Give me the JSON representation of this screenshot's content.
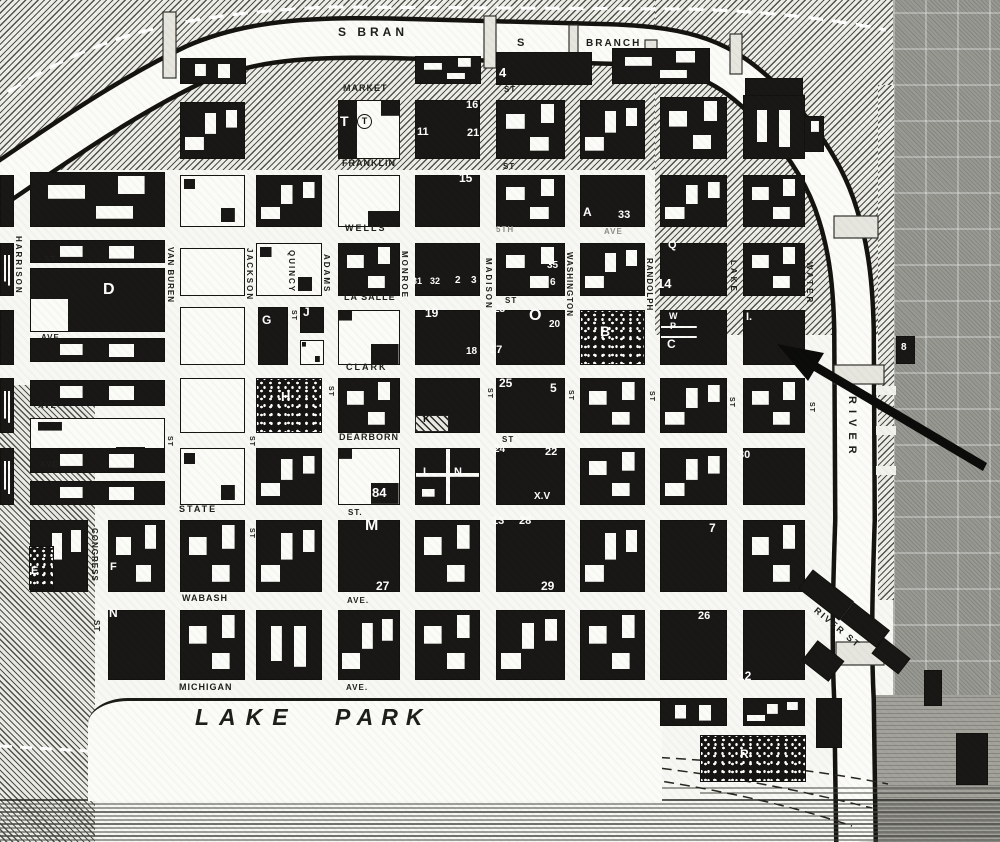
{
  "map": {
    "colors": {
      "paper": "#f7f7f3",
      "ink": "#181715",
      "river_fill": "#fbfbf7",
      "north_side_gray": "#9a9a94",
      "arrow": "#0b0b0a"
    },
    "river_labels_note": "south branch along top, main river on right, lake at bottom",
    "labels": [
      {
        "t": "S BRAN",
        "x": 338,
        "y": 26,
        "s": 12,
        "sp": 4
      },
      {
        "t": "S",
        "x": 517,
        "y": 38,
        "s": 11,
        "sp": 0
      },
      {
        "t": "BRANCH",
        "x": 586,
        "y": 39,
        "s": 10,
        "sp": 2
      },
      {
        "t": "MARKET",
        "x": 343,
        "y": 84,
        "s": 9,
        "sp": 1
      },
      {
        "t": "ST",
        "x": 504,
        "y": 86,
        "s": 8,
        "sp": 1
      },
      {
        "t": "FRANKLIN",
        "x": 342,
        "y": 159,
        "s": 9,
        "sp": 1
      },
      {
        "t": "ST",
        "x": 503,
        "y": 163,
        "s": 8,
        "sp": 1
      },
      {
        "t": "WELLS",
        "x": 345,
        "y": 224,
        "s": 9,
        "sp": 2
      },
      {
        "t": "5TH",
        "x": 496,
        "y": 226,
        "s": 8,
        "sp": 1,
        "c": "#8d8d86"
      },
      {
        "t": "AVE",
        "x": 604,
        "y": 228,
        "s": 8,
        "sp": 1,
        "c": "#8d8d86"
      },
      {
        "t": "LA SALLE",
        "x": 344,
        "y": 293,
        "s": 9,
        "sp": 1
      },
      {
        "t": "ST",
        "x": 505,
        "y": 297,
        "s": 8,
        "sp": 1
      },
      {
        "t": "CLARK",
        "x": 346,
        "y": 363,
        "s": 9,
        "sp": 2
      },
      {
        "t": "DEARBORN",
        "x": 339,
        "y": 433,
        "s": 9,
        "sp": 1
      },
      {
        "t": "ST",
        "x": 502,
        "y": 436,
        "s": 8,
        "sp": 1
      },
      {
        "t": "STATE",
        "x": 179,
        "y": 505,
        "s": 9,
        "sp": 2
      },
      {
        "t": "ST.",
        "x": 348,
        "y": 509,
        "s": 8,
        "sp": 1
      },
      {
        "t": "WABASH",
        "x": 182,
        "y": 594,
        "s": 9,
        "sp": 1
      },
      {
        "t": "AVE.",
        "x": 347,
        "y": 597,
        "s": 8,
        "sp": 1
      },
      {
        "t": "MICHIGAN",
        "x": 179,
        "y": 683,
        "s": 9,
        "sp": 1
      },
      {
        "t": "AVE.",
        "x": 346,
        "y": 684,
        "s": 8,
        "sp": 1
      },
      {
        "t": "ST.",
        "x": 44,
        "y": 256,
        "s": 8,
        "sp": 1
      },
      {
        "t": "AVE.",
        "x": 41,
        "y": 334,
        "s": 8,
        "sp": 1
      },
      {
        "t": "AVE",
        "x": 38,
        "y": 402,
        "s": 8,
        "sp": 1
      },
      {
        "t": "AVE.",
        "x": 40,
        "y": 461,
        "s": 8,
        "sp": 1
      },
      {
        "t": "LAKE",
        "x": 195,
        "y": 706,
        "s": 23,
        "sp": 10,
        "i": 1
      },
      {
        "t": "PARK",
        "x": 335,
        "y": 706,
        "s": 23,
        "sp": 8,
        "i": 1
      },
      {
        "t": "RIVER ST",
        "x": 818,
        "y": 606,
        "s": 9,
        "sp": 2,
        "r": 40
      },
      {
        "t": "HARRISON",
        "x": 14,
        "y": 236,
        "v": 1,
        "s": 8,
        "sp": 2
      },
      {
        "t": "VAN BUREN",
        "x": 166,
        "y": 247,
        "v": 1,
        "s": 8,
        "sp": 1
      },
      {
        "t": "JACKSON",
        "x": 245,
        "y": 248,
        "v": 1,
        "s": 8,
        "sp": 2
      },
      {
        "t": "QUINCY",
        "x": 287,
        "y": 250,
        "v": 1,
        "s": 8,
        "sp": 2
      },
      {
        "t": "ADAMS",
        "x": 322,
        "y": 254,
        "v": 1,
        "s": 8,
        "sp": 2
      },
      {
        "t": "MONROE",
        "x": 400,
        "y": 251,
        "v": 1,
        "s": 8,
        "sp": 2
      },
      {
        "t": "MADISON",
        "x": 484,
        "y": 258,
        "v": 1,
        "s": 8,
        "sp": 2
      },
      {
        "t": "WASHINGTON",
        "x": 565,
        "y": 252,
        "v": 1,
        "s": 8,
        "sp": 1
      },
      {
        "t": "RANDOLPH",
        "x": 645,
        "y": 258,
        "v": 1,
        "s": 8,
        "sp": 1
      },
      {
        "t": "LAKE",
        "x": 729,
        "y": 260,
        "v": 1,
        "s": 8,
        "sp": 3
      },
      {
        "t": "WATER",
        "x": 805,
        "y": 262,
        "v": 1,
        "s": 8,
        "sp": 3
      },
      {
        "t": "CONGRESS",
        "x": 90,
        "y": 528,
        "v": 1,
        "s": 8,
        "sp": 1
      },
      {
        "t": "ST",
        "x": 92,
        "y": 620,
        "v": 1,
        "s": 8,
        "sp": 1
      },
      {
        "t": "RIVER",
        "x": 846,
        "y": 396,
        "v": 1,
        "s": 11,
        "sp": 6
      },
      {
        "t": "ST",
        "x": 290,
        "y": 310,
        "v": 1,
        "s": 7,
        "sp": 1
      },
      {
        "t": "ST",
        "x": 327,
        "y": 386,
        "v": 1,
        "s": 7,
        "sp": 1
      },
      {
        "t": "ST",
        "x": 486,
        "y": 388,
        "v": 1,
        "s": 7,
        "sp": 1
      },
      {
        "t": "ST",
        "x": 567,
        "y": 390,
        "v": 1,
        "s": 7,
        "sp": 1
      },
      {
        "t": "ST",
        "x": 648,
        "y": 391,
        "v": 1,
        "s": 7,
        "sp": 1
      },
      {
        "t": "ST",
        "x": 728,
        "y": 397,
        "v": 1,
        "s": 7,
        "sp": 1
      },
      {
        "t": "ST",
        "x": 808,
        "y": 402,
        "v": 1,
        "s": 7,
        "sp": 1
      },
      {
        "t": "ST",
        "x": 166,
        "y": 436,
        "v": 1,
        "s": 7,
        "sp": 1
      },
      {
        "t": "ST",
        "x": 248,
        "y": 436,
        "v": 1,
        "s": 7,
        "sp": 1
      },
      {
        "t": "ST",
        "x": 248,
        "y": 528,
        "v": 1,
        "s": 7,
        "sp": 1
      }
    ],
    "building_marks": [
      {
        "t": "4",
        "x": 499,
        "y": 66,
        "s": 13
      },
      {
        "t": "T",
        "x": 340,
        "y": 114,
        "s": 14
      },
      {
        "t": "T",
        "x": 357,
        "y": 114,
        "s": 9,
        "c": "b",
        "circ": 1
      },
      {
        "t": "11",
        "x": 417,
        "y": 127,
        "s": 11
      },
      {
        "t": "16",
        "x": 466,
        "y": 100,
        "s": 11
      },
      {
        "t": "21",
        "x": 467,
        "y": 128,
        "s": 11
      },
      {
        "t": "15",
        "x": 459,
        "y": 172,
        "s": 12
      },
      {
        "t": "A",
        "x": 583,
        "y": 206,
        "s": 12
      },
      {
        "t": "33",
        "x": 618,
        "y": 210,
        "s": 11
      },
      {
        "t": "Q",
        "x": 668,
        "y": 240,
        "s": 11
      },
      {
        "t": "14",
        "x": 657,
        "y": 277,
        "s": 13
      },
      {
        "t": "31",
        "x": 412,
        "y": 277,
        "s": 9
      },
      {
        "t": "32",
        "x": 430,
        "y": 277,
        "s": 9
      },
      {
        "t": "2",
        "x": 455,
        "y": 276,
        "s": 10
      },
      {
        "t": "3",
        "x": 471,
        "y": 276,
        "s": 10
      },
      {
        "t": "35",
        "x": 547,
        "y": 261,
        "s": 10
      },
      {
        "t": "6",
        "x": 550,
        "y": 278,
        "s": 10
      },
      {
        "t": "19",
        "x": 425,
        "y": 307,
        "s": 12
      },
      {
        "t": "23",
        "x": 494,
        "y": 305,
        "s": 10
      },
      {
        "t": "O",
        "x": 529,
        "y": 308,
        "s": 16
      },
      {
        "t": "20",
        "x": 549,
        "y": 320,
        "s": 10
      },
      {
        "t": "18",
        "x": 466,
        "y": 347,
        "s": 10
      },
      {
        "t": "17",
        "x": 490,
        "y": 345,
        "s": 11
      },
      {
        "t": "B",
        "x": 600,
        "y": 324,
        "s": 14
      },
      {
        "t": "W",
        "x": 669,
        "y": 312,
        "s": 9
      },
      {
        "t": "P",
        "x": 670,
        "y": 322,
        "s": 9
      },
      {
        "t": "C",
        "x": 667,
        "y": 338,
        "s": 12
      },
      {
        "t": "I.",
        "x": 746,
        "y": 312,
        "s": 11
      },
      {
        "t": "D",
        "x": 103,
        "y": 282,
        "s": 16
      },
      {
        "t": "G",
        "x": 262,
        "y": 314,
        "s": 12
      },
      {
        "t": "J",
        "x": 303,
        "y": 306,
        "s": 12
      },
      {
        "t": "H",
        "x": 281,
        "y": 390,
        "s": 13
      },
      {
        "t": "K",
        "x": 423,
        "y": 415,
        "s": 10,
        "c": "b"
      },
      {
        "t": "25",
        "x": 499,
        "y": 377,
        "s": 12
      },
      {
        "t": "5",
        "x": 550,
        "y": 382,
        "s": 12
      },
      {
        "t": "84",
        "x": 372,
        "y": 486,
        "s": 13
      },
      {
        "t": "L",
        "x": 423,
        "y": 467,
        "s": 11
      },
      {
        "t": "N",
        "x": 454,
        "y": 467,
        "s": 11
      },
      {
        "t": "24",
        "x": 494,
        "y": 445,
        "s": 10
      },
      {
        "t": "22",
        "x": 545,
        "y": 447,
        "s": 11
      },
      {
        "t": "X.V",
        "x": 534,
        "y": 492,
        "s": 10
      },
      {
        "t": "M",
        "x": 365,
        "y": 518,
        "s": 16
      },
      {
        "t": "27",
        "x": 376,
        "y": 580,
        "s": 12
      },
      {
        "t": "13",
        "x": 492,
        "y": 516,
        "s": 11
      },
      {
        "t": "28",
        "x": 519,
        "y": 516,
        "s": 11
      },
      {
        "t": "29",
        "x": 541,
        "y": 580,
        "s": 12
      },
      {
        "t": "30",
        "x": 738,
        "y": 450,
        "s": 11
      },
      {
        "t": "7",
        "x": 709,
        "y": 522,
        "s": 12
      },
      {
        "t": "26",
        "x": 698,
        "y": 611,
        "s": 11
      },
      {
        "t": "12",
        "x": 738,
        "y": 670,
        "s": 12
      },
      {
        "t": "E",
        "x": 31,
        "y": 566,
        "s": 11
      },
      {
        "t": "F",
        "x": 110,
        "y": 562,
        "s": 11
      },
      {
        "t": "N",
        "x": 109,
        "y": 607,
        "s": 12
      },
      {
        "t": "I",
        "x": 216,
        "y": 652,
        "s": 12
      },
      {
        "t": "R",
        "x": 740,
        "y": 748,
        "s": 12
      },
      {
        "t": "8",
        "x": 901,
        "y": 343,
        "s": 10
      }
    ],
    "blocks": [
      [
        180,
        58,
        66,
        26,
        "m3"
      ],
      [
        415,
        56,
        66,
        28,
        "m1"
      ],
      [
        496,
        52,
        96,
        33,
        "s"
      ],
      [
        612,
        48,
        98,
        36,
        "m1"
      ],
      [
        745,
        78,
        58,
        32,
        "s"
      ],
      [
        778,
        116,
        46,
        36,
        "m2"
      ],
      [
        180,
        102,
        65,
        57,
        "m2"
      ],
      [
        338,
        100,
        62,
        59,
        "mT"
      ],
      [
        415,
        100,
        65,
        59,
        "s"
      ],
      [
        496,
        100,
        69,
        59,
        "m1"
      ],
      [
        580,
        100,
        65,
        59,
        "m2"
      ],
      [
        660,
        97,
        67,
        62,
        "m1"
      ],
      [
        743,
        95,
        62,
        64,
        "m3"
      ],
      [
        0,
        175,
        14,
        52,
        "s"
      ],
      [
        30,
        172,
        135,
        55,
        "m1"
      ],
      [
        180,
        175,
        65,
        52,
        "w2"
      ],
      [
        256,
        175,
        66,
        52,
        "m2"
      ],
      [
        338,
        175,
        62,
        52,
        "w3"
      ],
      [
        415,
        175,
        65,
        52,
        "s"
      ],
      [
        496,
        175,
        69,
        52,
        "m1"
      ],
      [
        580,
        175,
        65,
        52,
        "s"
      ],
      [
        660,
        175,
        67,
        52,
        "m2"
      ],
      [
        743,
        175,
        62,
        52,
        "m1"
      ],
      [
        0,
        243,
        14,
        53,
        "m3"
      ],
      [
        30,
        240,
        135,
        23,
        "m3"
      ],
      [
        30,
        268,
        135,
        64,
        "sD"
      ],
      [
        30,
        338,
        135,
        24,
        "m3"
      ],
      [
        180,
        248,
        65,
        48,
        "w"
      ],
      [
        256,
        243,
        66,
        53,
        "w2"
      ],
      [
        338,
        243,
        62,
        53,
        "m1"
      ],
      [
        415,
        243,
        65,
        53,
        "s"
      ],
      [
        496,
        243,
        69,
        53,
        "m1"
      ],
      [
        580,
        243,
        65,
        53,
        "m2"
      ],
      [
        660,
        243,
        67,
        53,
        "s"
      ],
      [
        743,
        243,
        62,
        53,
        "m1"
      ],
      [
        0,
        310,
        14,
        55,
        "s"
      ],
      [
        180,
        307,
        65,
        58,
        "w"
      ],
      [
        258,
        307,
        30,
        58,
        "s"
      ],
      [
        300,
        307,
        24,
        26,
        "s"
      ],
      [
        300,
        340,
        24,
        25,
        "w2"
      ],
      [
        338,
        310,
        62,
        55,
        "w2b"
      ],
      [
        415,
        310,
        65,
        55,
        "s"
      ],
      [
        496,
        310,
        69,
        55,
        "s"
      ],
      [
        580,
        310,
        65,
        55,
        "sp"
      ],
      [
        660,
        310,
        67,
        55,
        "wpc"
      ],
      [
        743,
        310,
        62,
        55,
        "s"
      ],
      [
        0,
        378,
        14,
        55,
        "m3"
      ],
      [
        30,
        380,
        135,
        26,
        "m3"
      ],
      [
        30,
        418,
        135,
        45,
        "w2"
      ],
      [
        180,
        378,
        65,
        55,
        "w"
      ],
      [
        256,
        378,
        66,
        55,
        "sp"
      ],
      [
        338,
        378,
        62,
        55,
        "m1"
      ],
      [
        415,
        378,
        65,
        55,
        "s"
      ],
      [
        496,
        378,
        69,
        55,
        "s"
      ],
      [
        580,
        378,
        65,
        55,
        "m1"
      ],
      [
        660,
        378,
        67,
        55,
        "m2"
      ],
      [
        743,
        378,
        62,
        55,
        "m1"
      ],
      [
        415,
        415,
        34,
        17,
        "hpat"
      ],
      [
        0,
        448,
        14,
        57,
        "m3"
      ],
      [
        30,
        448,
        135,
        25,
        "m3"
      ],
      [
        30,
        481,
        135,
        24,
        "m3"
      ],
      [
        180,
        448,
        65,
        57,
        "w2"
      ],
      [
        256,
        448,
        66,
        57,
        "m2"
      ],
      [
        338,
        448,
        62,
        57,
        "w2b"
      ],
      [
        415,
        448,
        65,
        57,
        "cross"
      ],
      [
        496,
        448,
        69,
        57,
        "s"
      ],
      [
        580,
        448,
        65,
        57,
        "m1"
      ],
      [
        660,
        448,
        67,
        57,
        "m2"
      ],
      [
        743,
        448,
        62,
        57,
        "s"
      ],
      [
        30,
        520,
        58,
        72,
        "m2"
      ],
      [
        108,
        520,
        57,
        72,
        "m1"
      ],
      [
        180,
        520,
        65,
        72,
        "m1"
      ],
      [
        256,
        520,
        66,
        72,
        "m2"
      ],
      [
        338,
        520,
        62,
        72,
        "s"
      ],
      [
        415,
        520,
        65,
        72,
        "m1"
      ],
      [
        496,
        520,
        69,
        72,
        "s"
      ],
      [
        580,
        520,
        65,
        72,
        "m2"
      ],
      [
        660,
        520,
        67,
        72,
        "s"
      ],
      [
        743,
        520,
        62,
        72,
        "m1"
      ],
      [
        29,
        546,
        25,
        44,
        "sp"
      ],
      [
        108,
        610,
        57,
        70,
        "s"
      ],
      [
        180,
        610,
        65,
        70,
        "m1"
      ],
      [
        256,
        610,
        66,
        70,
        "m3"
      ],
      [
        338,
        610,
        62,
        70,
        "m2"
      ],
      [
        415,
        610,
        65,
        70,
        "m1"
      ],
      [
        496,
        610,
        69,
        70,
        "m2"
      ],
      [
        580,
        610,
        65,
        70,
        "m1"
      ],
      [
        660,
        610,
        67,
        70,
        "s"
      ],
      [
        743,
        610,
        62,
        70,
        "s"
      ],
      [
        660,
        698,
        67,
        28,
        "m3"
      ],
      [
        743,
        698,
        62,
        28,
        "m2"
      ],
      [
        700,
        735,
        106,
        47,
        "sp"
      ],
      [
        816,
        698,
        26,
        50,
        "s"
      ],
      [
        800,
        583,
        52,
        24,
        "s",
        38
      ],
      [
        842,
        614,
        46,
        22,
        "s",
        38
      ],
      [
        874,
        646,
        34,
        20,
        "s",
        38
      ],
      [
        806,
        648,
        34,
        26,
        "s",
        38
      ],
      [
        896,
        336,
        19,
        28,
        "s"
      ],
      [
        924,
        670,
        18,
        36,
        "s"
      ],
      [
        956,
        733,
        32,
        52,
        "s"
      ]
    ],
    "arrow": {
      "points": "777,344 824,353 818,363 987,463 983,471 814,371 808,381"
    }
  }
}
